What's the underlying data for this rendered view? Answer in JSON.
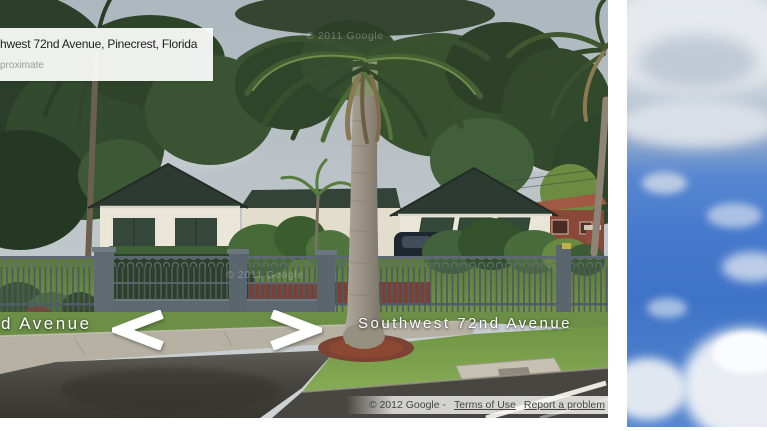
{
  "street_view": {
    "address_box": {
      "title_visible": "hwest 72nd Avenue, Pinecrest, Florida",
      "subtitle_visible": "proximate"
    },
    "street_labels": {
      "left_partial": "d Avenue",
      "center": "Southwest 72nd Avenue"
    },
    "tile_watermark": "© 2011 Google",
    "attribution": {
      "copyright": "© 2012 Google -",
      "terms_of_use": "Terms of Use",
      "report_a_problem": "Report a problem"
    },
    "nav_arrows": [
      {
        "direction": "left"
      },
      {
        "direction": "right"
      }
    ]
  },
  "scene": {
    "colors": {
      "overcast_sky": "#b3bcc3",
      "house_wall": "#e9e5d7",
      "roof": "#2c3a31",
      "shutters": "#36483b",
      "fence_metal": "#56616b",
      "lawn": "#6f9447",
      "asphalt": "#44433f",
      "sidewalk": "#b6b1a3",
      "mulch": "#7c4233",
      "palm_trunk": "#9a9488",
      "blue_sky": "#4479cd"
    }
  }
}
